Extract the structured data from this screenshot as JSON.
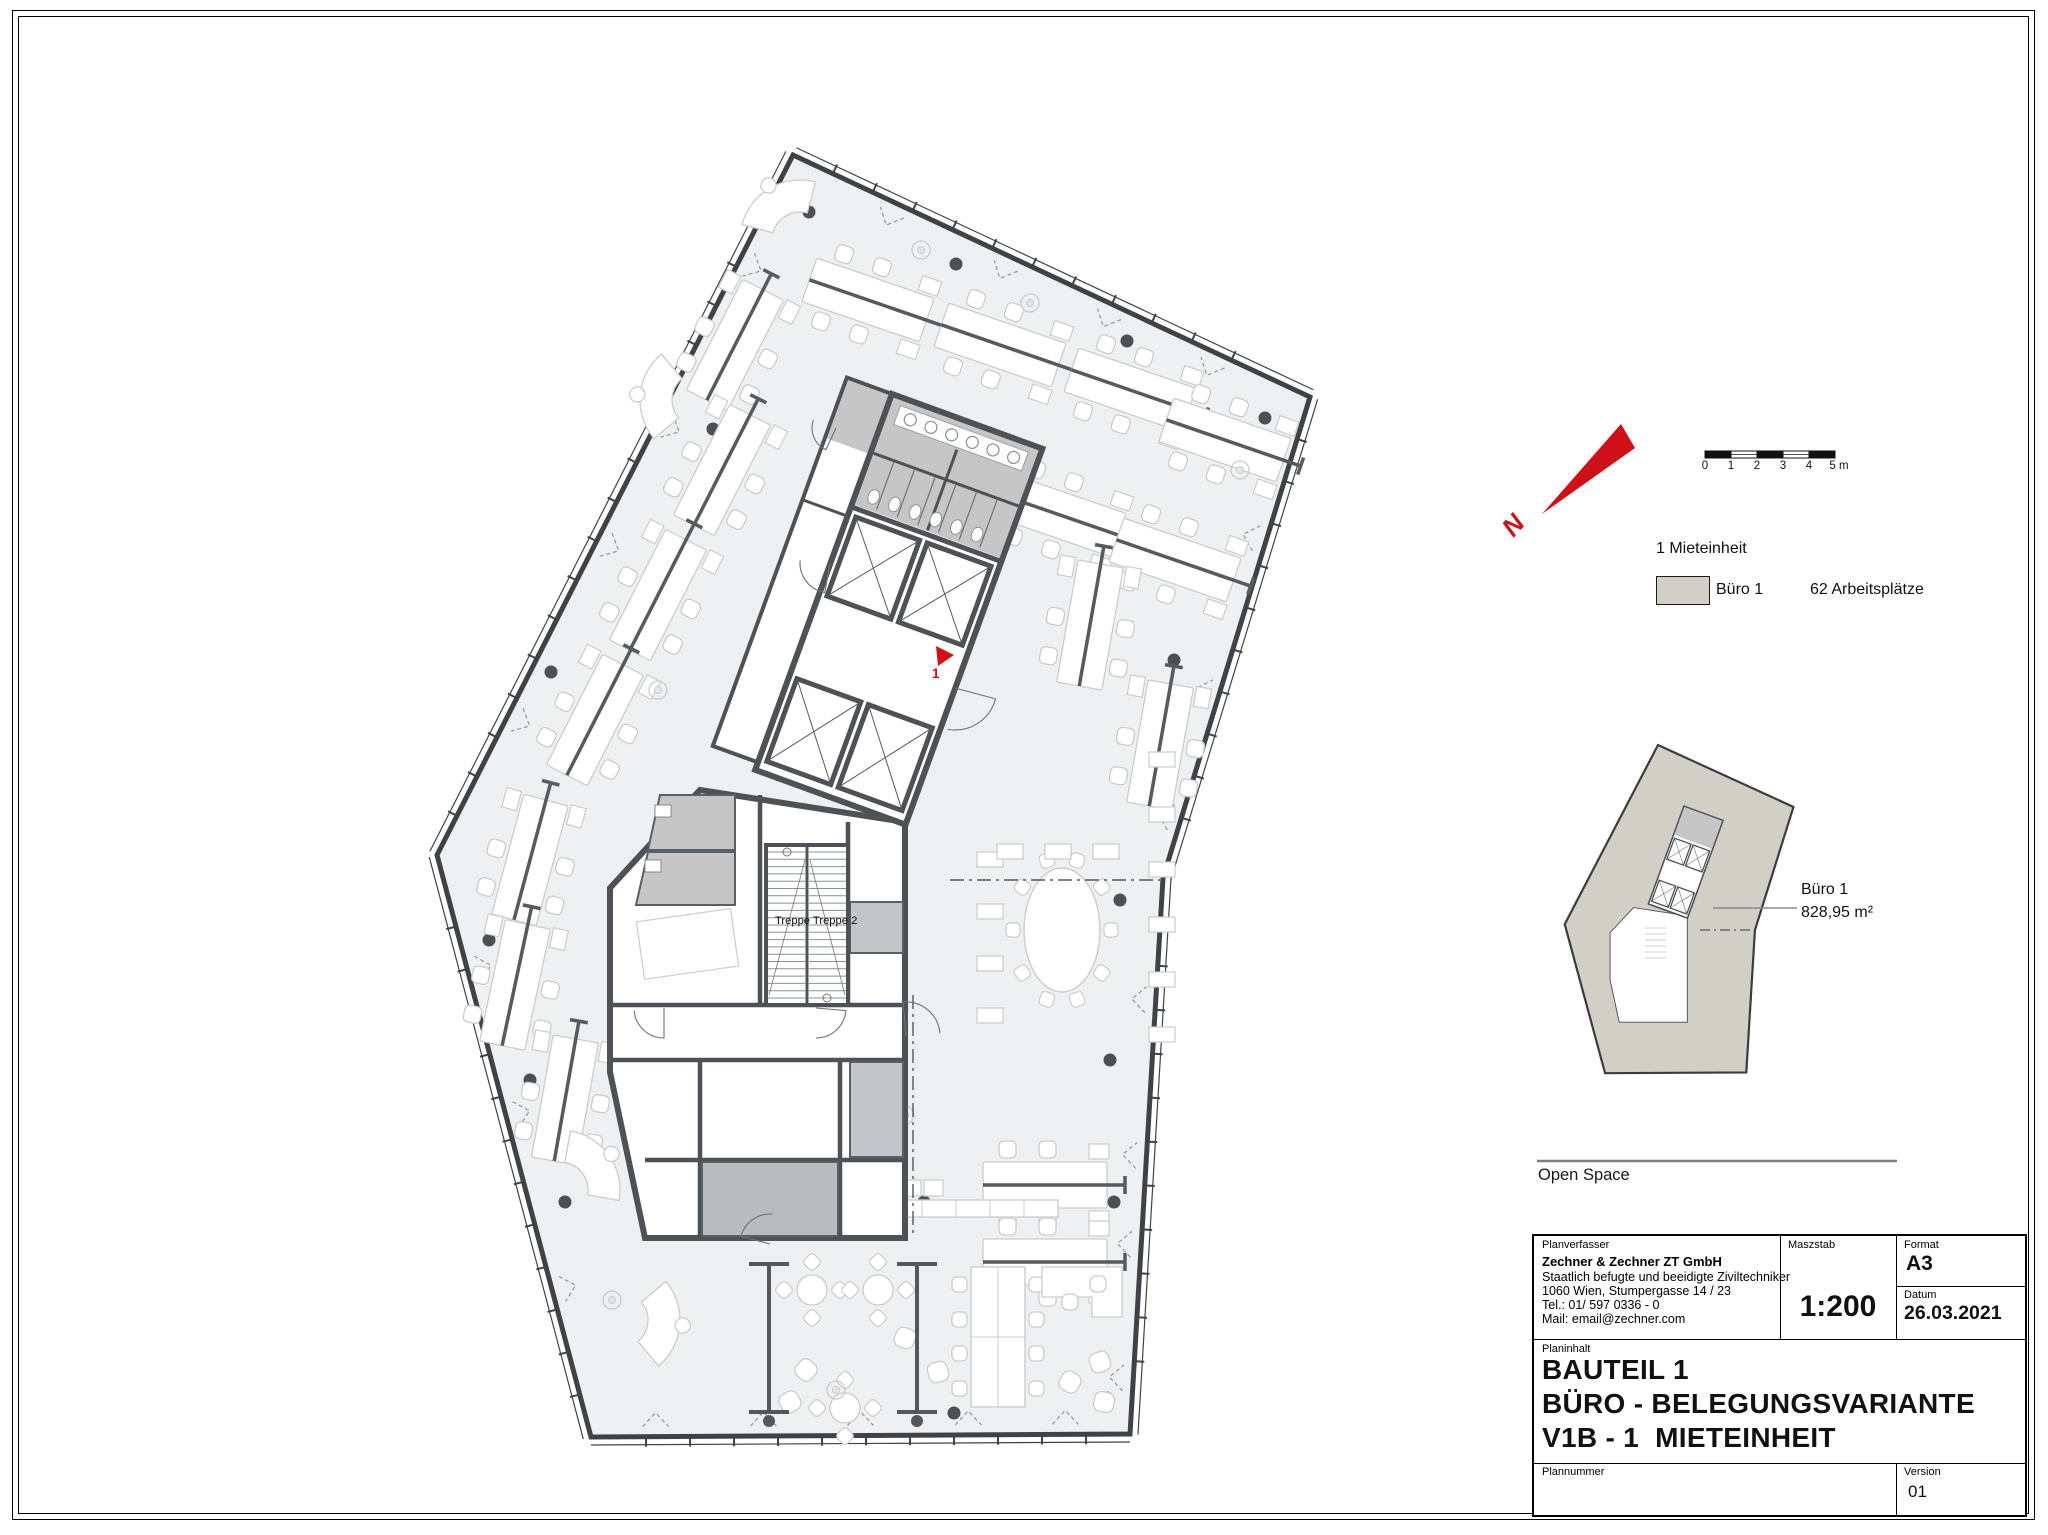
{
  "colors": {
    "red": "#cf1016",
    "floor": "#eff0f2",
    "suite_fill": "#d2cfc6",
    "wall": "#4e5256",
    "wc_gray": "#c6c6c6",
    "gray2": "#b9bcbe",
    "gray3": "#c3c6c8",
    "furniture_stroke": "#c9cdd0",
    "outline": "#3f4347",
    "leader": "#8a8a8a",
    "rule": "#7d8084"
  },
  "north": {
    "label": "N"
  },
  "scalebar": {
    "labels": [
      "0",
      "1",
      "2",
      "3",
      "4",
      "5 m"
    ]
  },
  "legend": {
    "title": "1 Mieteinheit",
    "items": [
      {
        "label": "Büro 1",
        "value": "62 Arbeitsplätze"
      }
    ]
  },
  "keyplan": {
    "label": "Büro 1",
    "area": "828,95 m²",
    "anchor": [
      1658,
      745
    ],
    "scale": [
      0.262,
      0.256
    ]
  },
  "open_space": {
    "label": "Open Space"
  },
  "titleblock": {
    "planverfasser_label": "Planverfasser",
    "company": "Zechner & Zechner ZT GmbH",
    "company_line2": "Staatlich befugte und beeidigte Ziviltechniker",
    "address": "1060 Wien, Stumpergasse 14 / 23",
    "phone": "Tel.: 01/ 597 0336 - 0",
    "mail": "Mail: email@zechner.com",
    "maszstab_label": "Maszstab",
    "maszstab_value": "1:200",
    "format_label": "Format",
    "format_value": "A3",
    "datum_label": "Datum",
    "datum_value": "26.03.2021",
    "planinhalt_label": "Planinhalt",
    "title_line1": "BAUTEIL 1",
    "title_line2": "BÜRO - BELEGUNGSVARIANTE",
    "title_line3": "V1B - 1  MIETEINHEIT",
    "plannummer_label": "Plannummer",
    "plannummer_value": "",
    "version_label": "Version",
    "version_value": "01"
  },
  "plan": {
    "stairs_label": "Treppe Treppe 2",
    "marker_label": "1",
    "marker_triangle": [
      [
        936,
        646
      ],
      [
        954,
        655
      ],
      [
        938,
        666
      ]
    ],
    "outline": [
      [
        793,
        155
      ],
      [
        1310,
        397
      ],
      [
        1163,
        878
      ],
      [
        1130,
        1434
      ],
      [
        591,
        1437
      ],
      [
        437,
        855
      ]
    ],
    "chevrons": [
      [
        0.2,
        0.42,
        0.62,
        0.82
      ],
      [
        0.3,
        0.62,
        0.88
      ],
      [
        0.22,
        0.5,
        0.66,
        0.9
      ],
      [
        0.12,
        0.3,
        0.5,
        0.68,
        0.88
      ],
      [
        0.25,
        0.55,
        0.8
      ],
      [
        0.2,
        0.45,
        0.62,
        0.85
      ]
    ],
    "columns": [
      [
        809,
        212
      ],
      [
        956,
        264
      ],
      [
        1127,
        341
      ],
      [
        1265,
        418
      ],
      [
        713,
        429
      ],
      [
        551,
        672
      ],
      [
        1174,
        660
      ],
      [
        489,
        940
      ],
      [
        530,
        1080
      ],
      [
        565,
        1202
      ],
      [
        687,
        1202
      ],
      [
        924,
        1202
      ],
      [
        1114,
        1202
      ],
      [
        954,
        1413
      ],
      [
        1107,
        1398
      ],
      [
        1120,
        900
      ],
      [
        1110,
        1060
      ]
    ],
    "benches": [
      [
        735,
        345,
        -63
      ],
      [
        722,
        470,
        -63
      ],
      [
        658,
        595,
        -63
      ],
      [
        595,
        720,
        -63
      ],
      [
        530,
        860,
        -75
      ],
      [
        515,
        985,
        -78
      ],
      [
        565,
        1100,
        -80
      ],
      [
        868,
        300,
        19
      ],
      [
        1000,
        345,
        19
      ],
      [
        1130,
        390,
        19
      ],
      [
        1225,
        440,
        19
      ],
      [
        930,
        470,
        19
      ],
      [
        1060,
        515,
        19
      ],
      [
        1175,
        560,
        19
      ],
      [
        1090,
        625,
        -80
      ],
      [
        1160,
        745,
        -80
      ],
      [
        1045,
        1185,
        0
      ],
      [
        1045,
        1262,
        0
      ]
    ],
    "curves": [
      [
        800,
        240,
        15
      ],
      [
        700,
        400,
        -40
      ],
      [
        560,
        1190,
        100
      ],
      [
        620,
        1320,
        140
      ]
    ],
    "rounds": [
      [
        812,
        1290
      ],
      [
        878,
        1290
      ],
      [
        845,
        1408
      ]
    ],
    "lounges": [
      [
        905,
        1338,
        20
      ],
      [
        938,
        1372,
        -15
      ],
      [
        1070,
        1382,
        30
      ],
      [
        1100,
        1362,
        -20
      ],
      [
        1104,
        1402,
        10
      ],
      [
        806,
        1370,
        40
      ],
      [
        790,
        1402,
        -30
      ]
    ],
    "plants": [
      [
        921,
        250
      ],
      [
        1030,
        303
      ],
      [
        658,
        690
      ],
      [
        905,
        1115
      ],
      [
        836,
        1390
      ],
      [
        612,
        1300
      ],
      [
        1240,
        470
      ]
    ],
    "partitions": [
      [
        769,
        1264,
        1412
      ],
      [
        917,
        1264,
        1412
      ]
    ],
    "oval": [
      1062,
      930
    ],
    "table8": [
      998,
      1337
    ],
    "ldesk": [
      1082,
      1292
    ],
    "shelves": [
      [
        1162,
        760
      ],
      [
        1162,
        815
      ],
      [
        1162,
        870
      ],
      [
        1162,
        925
      ],
      [
        1162,
        980
      ],
      [
        1162,
        1035
      ],
      [
        990,
        860
      ],
      [
        990,
        912
      ],
      [
        990,
        964
      ],
      [
        990,
        1016
      ],
      [
        1010,
        852
      ],
      [
        1058,
        852
      ],
      [
        1106,
        852
      ]
    ],
    "counter_squares": [
      [
        792,
        1180
      ],
      [
        814,
        1180
      ],
      [
        836,
        1180
      ],
      [
        858,
        1180
      ],
      [
        880,
        1180
      ],
      [
        902,
        1180
      ],
      [
        924,
        1180
      ]
    ],
    "counter_bar": [
      786,
      1200,
      272,
      17
    ],
    "dash_lines": [
      [
        950,
        880,
        1160,
        880
      ],
      [
        913,
        995,
        913,
        1238
      ]
    ],
    "key_dash": [
      1700,
      930,
      1753,
      930
    ],
    "leader": [
      1713,
      908,
      1797,
      908
    ],
    "core_upper": {
      "origin": [
        892,
        394
      ],
      "rotation": 20
    },
    "lower_poly": [
      [
        700,
        790
      ],
      [
        905,
        822
      ],
      [
        905,
        1238
      ],
      [
        645,
        1238
      ],
      [
        610,
        1072
      ],
      [
        610,
        888
      ]
    ]
  }
}
